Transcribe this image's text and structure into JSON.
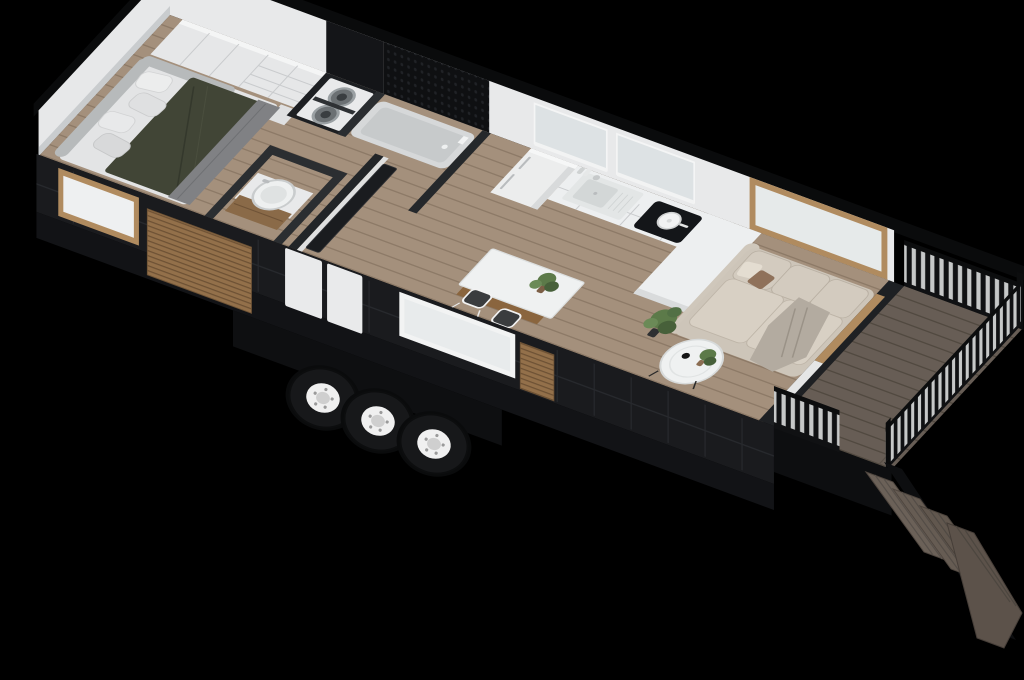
{
  "image": {
    "kind": "3d-isometric-cutaway-floorplan-render",
    "subject": "tiny house on wheels with side deck",
    "background": "#000000",
    "visible_text": ""
  },
  "palette": {
    "background": "#000000",
    "exterior_wall": "#1a1b1e",
    "wall_cut_edge": "#0a0b0c",
    "interior_wall": "#e8e9ea",
    "floor_wood": "#a4907c",
    "floor_line": "#8d7a67",
    "deck_wood": "#675d55",
    "deck_line": "#514940",
    "rattan_accent": "#93704a",
    "window_glass": "#dde2e4",
    "window_frame_wood": "#b08b5f",
    "duvet_olive": "#414536",
    "blanket_gray": "#808184",
    "sofa_beige": "#cdc5b9",
    "throw_gray": "#b3aba0",
    "island_wood": "#a07a50",
    "counter_white": "#edeff0",
    "cooktop_black": "#141619",
    "tub_gray": "#d6d8d9",
    "tire_black": "#17181a",
    "rim_white": "#f0f0f0",
    "plant_green": "#5c7a49",
    "upholstery_gray": "#b7babb"
  },
  "scene": {
    "rooms": [
      {
        "name": "bedroom",
        "objects": [
          "wardrobe",
          "platform-bed",
          "pillows",
          "olive-duvet",
          "gray-blanket",
          "upholstered-surround",
          "nightstand"
        ]
      },
      {
        "name": "laundry-closet",
        "objects": [
          "stacked-washer-dryer"
        ]
      },
      {
        "name": "bathroom",
        "objects": [
          "black-penny-tile-wall",
          "bathtub",
          "round-basin-vanity",
          "wood-vanity-cabinet"
        ]
      },
      {
        "name": "hallway",
        "objects": [
          "entry-door"
        ]
      },
      {
        "name": "kitchen",
        "objects": [
          "refrigerator",
          "counter-run",
          "inset-sink",
          "faucet",
          "soap-bottles",
          "induction-cooktop",
          "white-pot",
          "peninsula-counter",
          "kitchen-island",
          "island-plant",
          "bar-stool",
          "bar-stool"
        ]
      },
      {
        "name": "living-room",
        "objects": [
          "sofa",
          "throw-blanket",
          "accent-pillow",
          "coffee-table",
          "table-plant",
          "floor-plant",
          "picture-window"
        ]
      }
    ],
    "exterior": {
      "trailer": [
        "wheel",
        "wheel",
        "wheel",
        "black-panel-siding",
        "rattan-slat-accents",
        "front-windows"
      ],
      "deck": [
        "deck-floor",
        "slat-railing-back",
        "slat-railing-end",
        "slat-railing-front",
        "stairs-4-steps"
      ]
    },
    "counts": {
      "wheels": 3,
      "bar_stools": 2,
      "deck_steps": 4,
      "plants": 3,
      "sofa_back_cushions": 3
    }
  }
}
